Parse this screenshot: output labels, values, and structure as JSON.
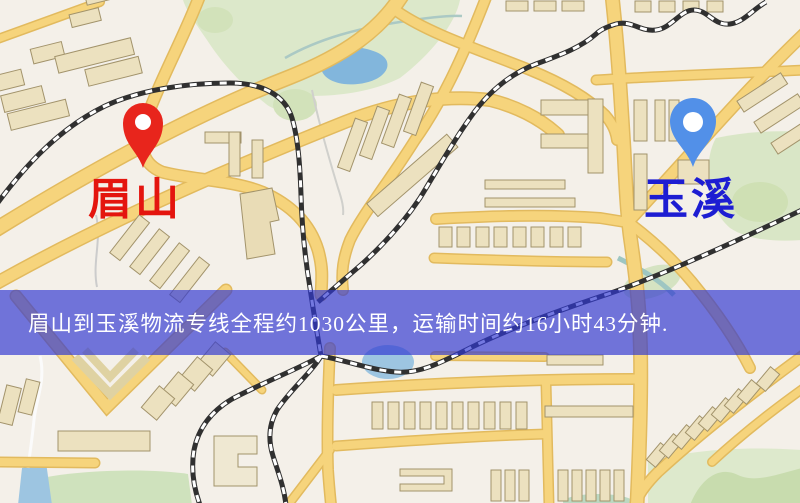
{
  "map": {
    "origin": {
      "name": "眉山",
      "label_color": "#e4150e",
      "pin_color": "#e8251c",
      "pin_icon": "red-location-pin"
    },
    "destination": {
      "name": "玉溪",
      "label_color": "#1d1dd2",
      "pin_color": "#5290e8",
      "pin_icon": "blue-location-pin"
    },
    "banner": {
      "text": "眉山到玉溪物流专线全程约1030公里，运输时间约16小时43分钟.",
      "background": "rgba(48,56,210,0.68)",
      "text_color": "#ffffff",
      "distance_km": 1030,
      "duration_hours": 16,
      "duration_minutes": 43
    },
    "legend_colors": {
      "background": "#f4f0e9",
      "road": "#f6d47c",
      "building": "#ece1bf",
      "park": "#dce8ca",
      "water": "#9dc5e1",
      "railway": "#303030"
    }
  }
}
